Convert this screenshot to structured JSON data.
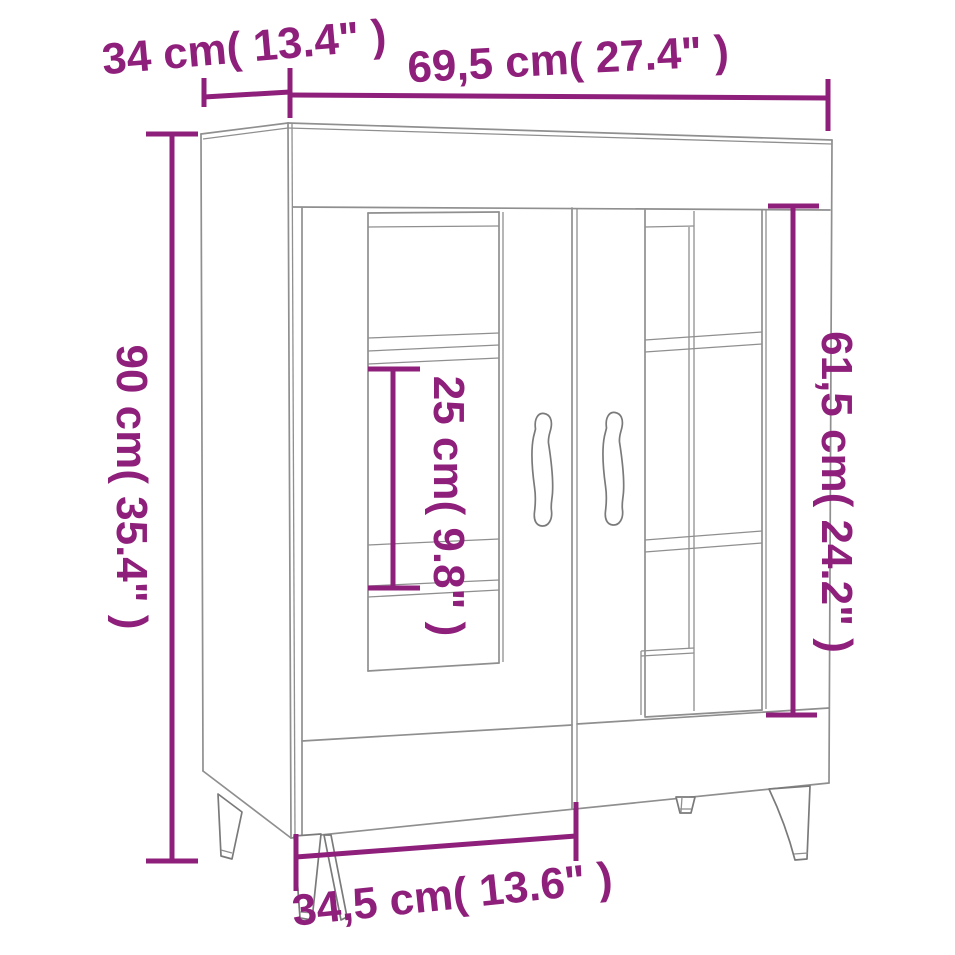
{
  "page": {
    "background": "#ffffff"
  },
  "diagram": {
    "type": "furniture-dimension-line-drawing",
    "subject": "sideboard with two glass doors, interior shelves and tapered legs",
    "colors": {
      "dimension_accent": "#8e1f7a",
      "drawing_outline": "#8f8f8f"
    },
    "dimensions": {
      "depth": {
        "label": "34 cm( 13.4\" )",
        "cm": "34",
        "inches": "13.4"
      },
      "width": {
        "label": "69,5 cm( 27.4\" )",
        "cm": "69,5",
        "inches": "27.4"
      },
      "height": {
        "label": "90 cm( 35.4\" )",
        "cm": "90",
        "inches": "35.4"
      },
      "shelf_gap": {
        "label": "25 cm( 9.8\" )",
        "cm": "25",
        "inches": "9.8"
      },
      "inner_height": {
        "label": "61,5 cm( 24.2\" )",
        "cm": "61,5",
        "inches": "24.2"
      },
      "base_width": {
        "label": "34,5 cm( 13.6\" )",
        "cm": "34,5",
        "inches": "13.6"
      }
    }
  }
}
